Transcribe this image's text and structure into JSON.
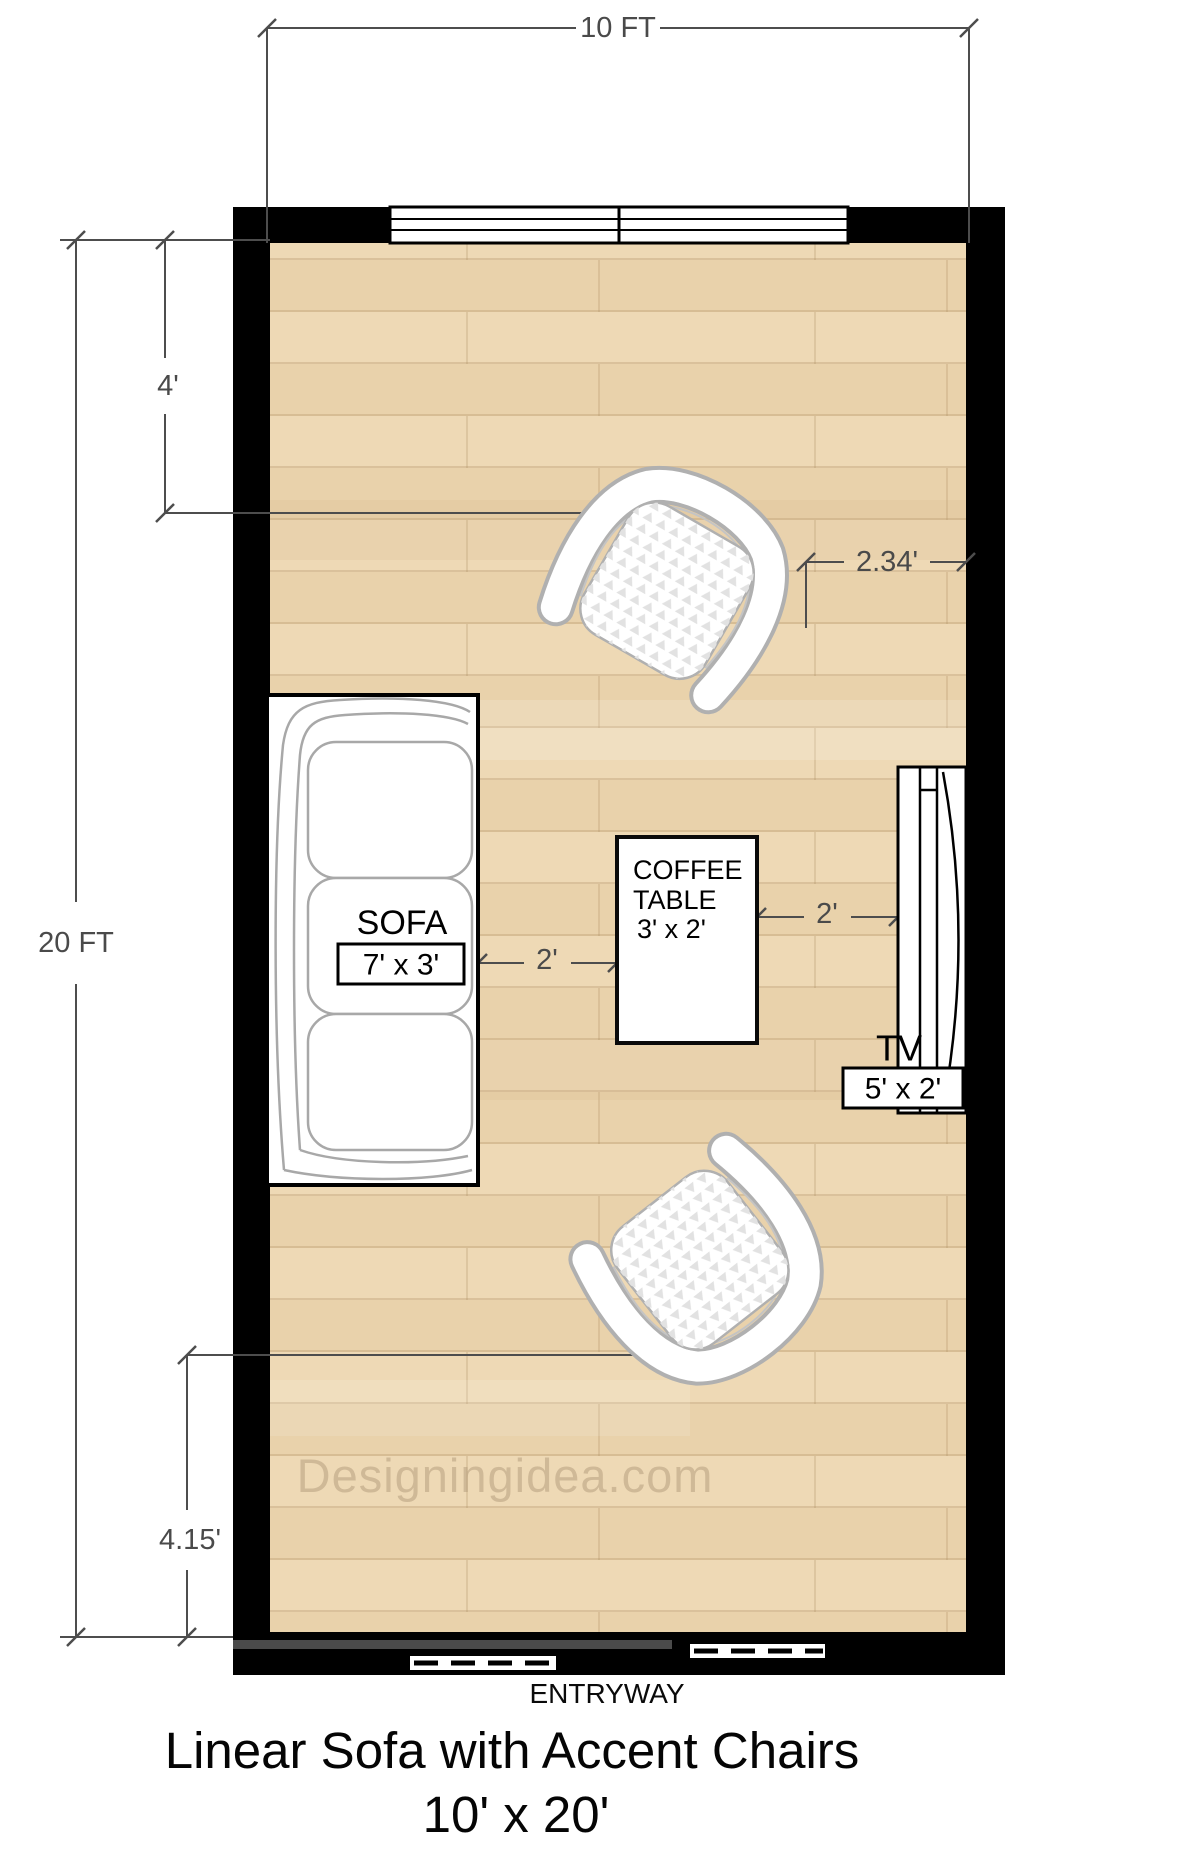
{
  "title": {
    "line1": "Linear Sofa with Accent Chairs",
    "line2": "10' x 20'"
  },
  "watermark": "Designingidea.com",
  "labels": {
    "entryway": "ENTRYWAY"
  },
  "dimensions": {
    "room_width": "10 FT",
    "room_height": "20 FT",
    "top_chair_offset": "4'",
    "top_chair_to_wall": "2.34'",
    "sofa_to_table": "2'",
    "table_to_tv": "2'",
    "bottom_chair_offset": "4.15'"
  },
  "furniture": {
    "sofa": {
      "name": "SOFA",
      "size": "7' x 3'"
    },
    "coffee_table": {
      "name_line1": "COFFEE",
      "name_line2": "TABLE",
      "size": "3' x 2'"
    },
    "tv": {
      "name": "TV",
      "size": "5' x 2'"
    }
  },
  "colors": {
    "wall": "#000000",
    "floor_plank_light": "#eed9b5",
    "floor_plank_dark": "#e9d2ab",
    "dimension": "#4a4a4a",
    "watermark": "#b49c7c",
    "furniture_outline": "#a8a8a8"
  }
}
